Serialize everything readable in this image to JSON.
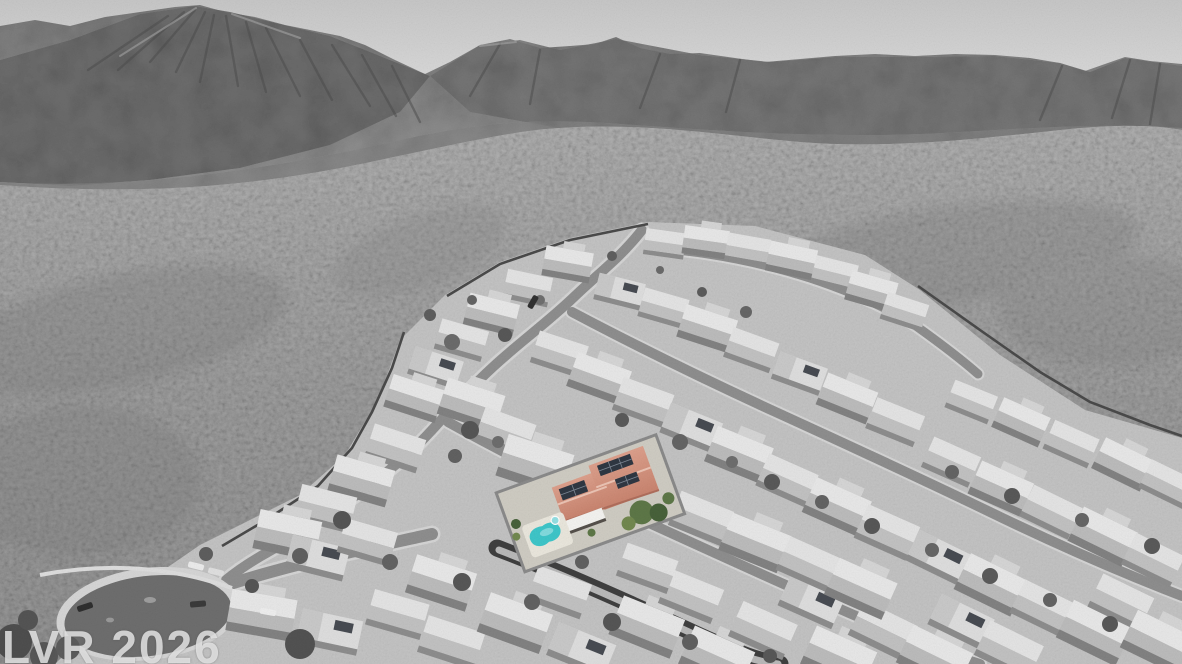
{
  "watermark": {
    "text": "LVR 2026"
  },
  "scene": {
    "type": "aerial-drone-photo",
    "treatment": "grayscale photo with one property highlighted in color",
    "colors": {
      "sky_top": "#c7c7c7",
      "sky_bottom": "#e2e2e2",
      "highlight_roof": "#c9846f",
      "highlight_roof_light": "#dda08c",
      "highlight_ridge": "#ecc4b4",
      "solar_panel": "#2f3742",
      "pool_water": "#3ec6c9",
      "pool_shallow": "#93e0e3",
      "pool_deck": "#eae7dd",
      "patio_cover": "#f4f3f0",
      "tree_green": "#5d7747",
      "tree_green_dark": "#47613a",
      "shrub_green": "#72884f"
    }
  }
}
